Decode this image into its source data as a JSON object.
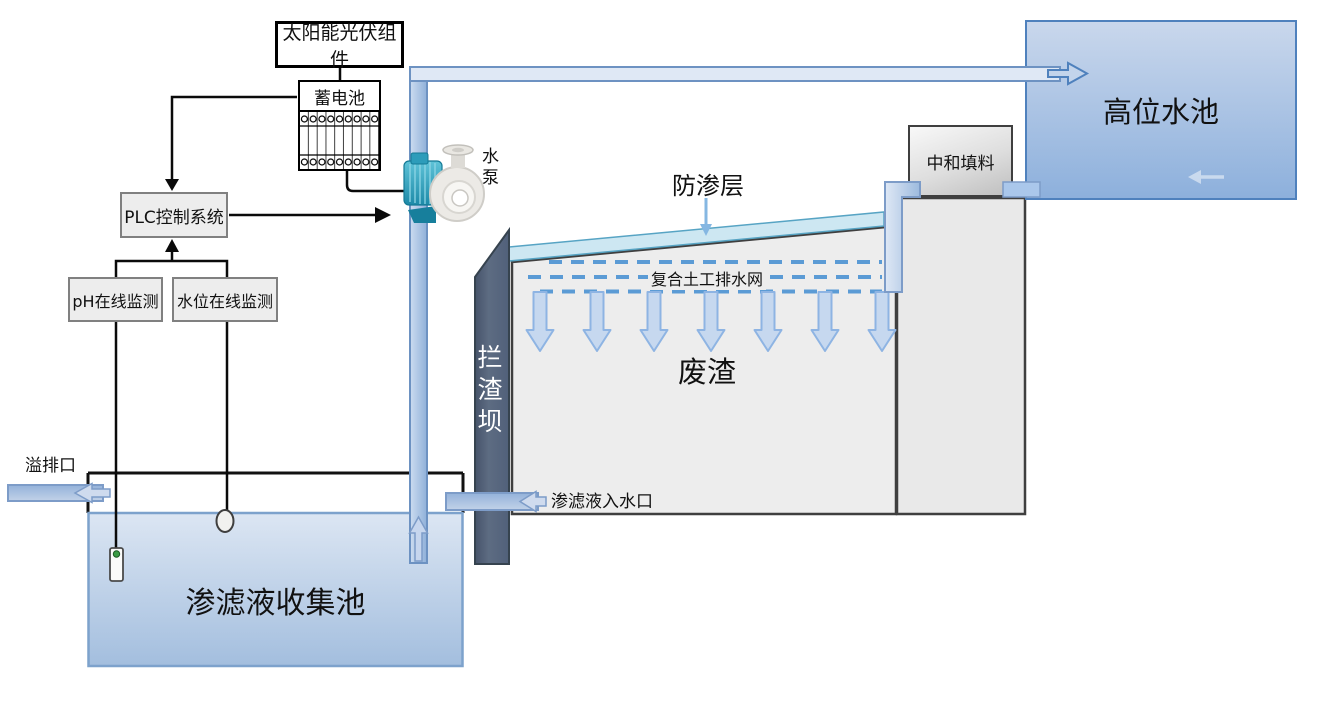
{
  "control": {
    "solar": "太阳能光伏组件",
    "battery": "蓄电池",
    "plc": "PLC控制系统",
    "ph_monitor": "pH在线监测",
    "level_monitor": "水位在线监测"
  },
  "equipment": {
    "pump": "水泵"
  },
  "landfill": {
    "liner": "防渗层",
    "drainage_net": "复合土工排水网",
    "waste": "废渣",
    "dam": "拦渣坝",
    "neutralizing_filler": "中和填料"
  },
  "pools": {
    "high_level_pool": "高位水池",
    "leachate_pool": "渗滤液收集池"
  },
  "ports": {
    "overflow_outlet": "溢排口",
    "leachate_inlet": "渗滤液入水口"
  },
  "colors": {
    "dash_blue": "#5b9bd5",
    "waste_fill": "#ededed",
    "liner_fill": "#cde7f2",
    "pipe_stroke": "#7d9cc8",
    "pipe_fill": "#dfe8f5",
    "pool_border": "#4f81bd",
    "dam_fill": "#57667b",
    "line_black": "#0a0a0a"
  }
}
